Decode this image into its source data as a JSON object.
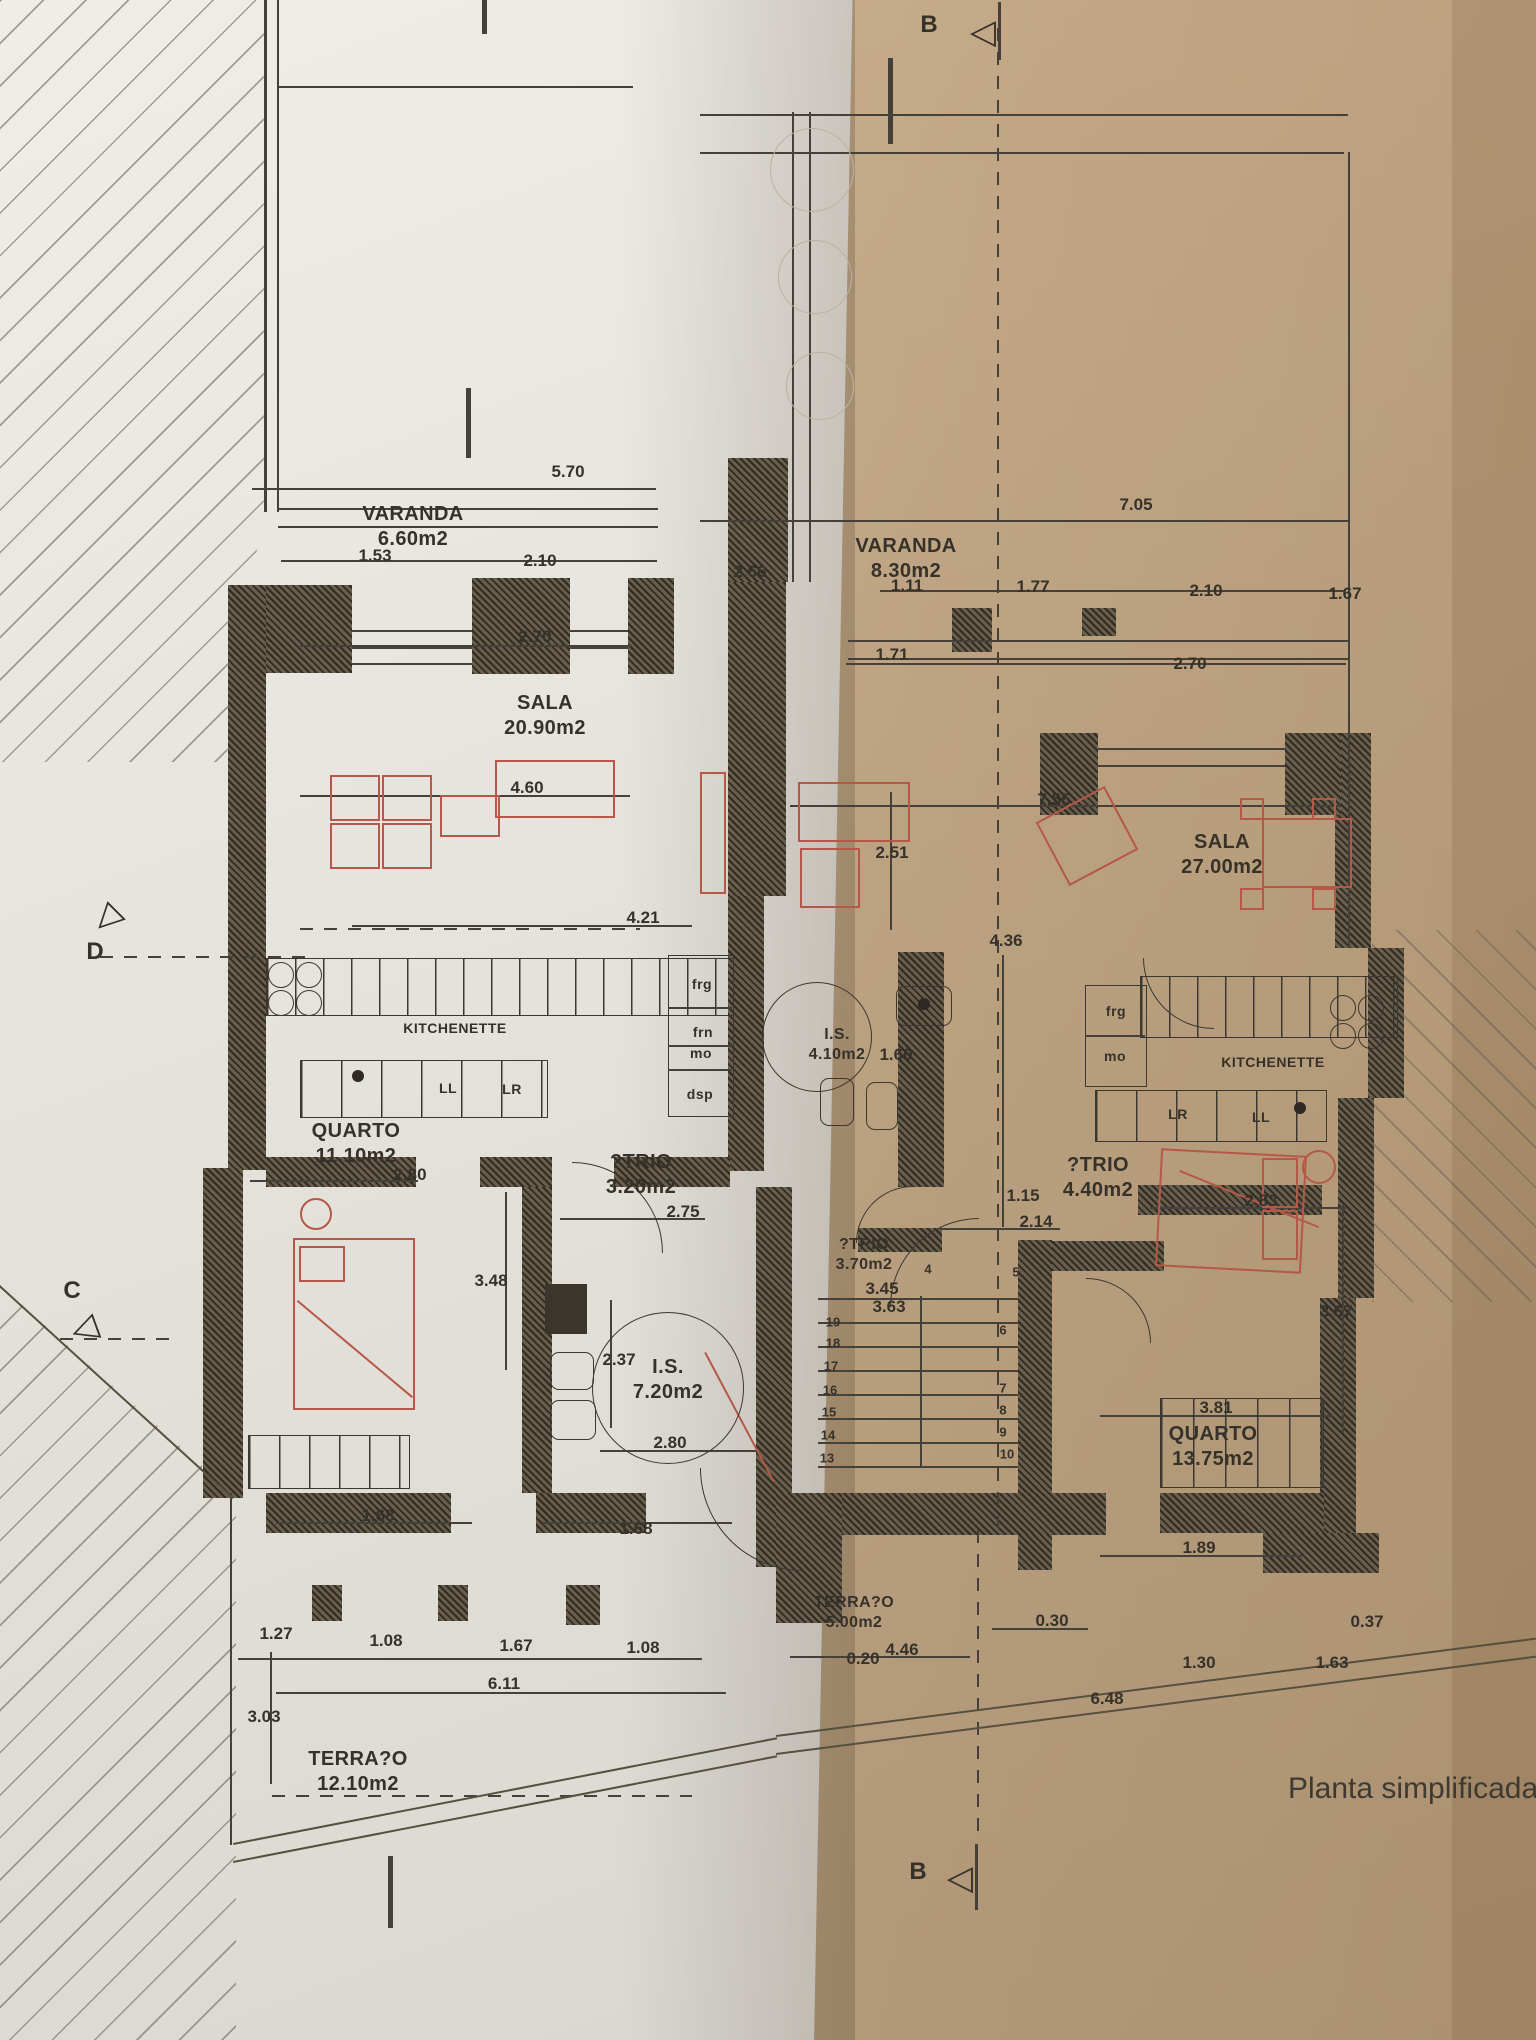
{
  "caption": {
    "text": "Planta simplificada d",
    "x": 1288,
    "y": 1772
  },
  "section_markers": [
    {
      "id": "b-top",
      "letter": "B",
      "x": 929,
      "y": 25,
      "icon": "section-flag",
      "icon_x": 983,
      "icon_y": 32,
      "icon_rot": 0
    },
    {
      "id": "b-bottom",
      "letter": "B",
      "x": 918,
      "y": 1872,
      "icon": "section-flag",
      "icon_x": 960,
      "icon_y": 1878,
      "icon_rot": 0
    },
    {
      "id": "d-left",
      "letter": "D",
      "x": 95,
      "y": 952,
      "icon": "section-flag",
      "icon_x": 106,
      "icon_y": 918,
      "icon_rot": -45
    },
    {
      "id": "c-left",
      "letter": "C",
      "x": 72,
      "y": 1291,
      "icon": "section-flag",
      "icon_x": 84,
      "icon_y": 1328,
      "icon_rot": -20
    }
  ],
  "rooms": [
    {
      "name": "VARANDA",
      "area": "6.60m2",
      "x": 413,
      "y": 527
    },
    {
      "name": "VARANDA",
      "area": "8.30m2",
      "x": 906,
      "y": 559
    },
    {
      "name": "SALA",
      "area": "20.90m2",
      "x": 545,
      "y": 716
    },
    {
      "name": "SALA",
      "area": "27.00m2",
      "x": 1222,
      "y": 855
    },
    {
      "name": "QUARTO",
      "area": "11.10m2",
      "x": 356,
      "y": 1144
    },
    {
      "name": "?TRIO",
      "area": "3.20m2",
      "x": 641,
      "y": 1175
    },
    {
      "name": "?TRIO",
      "area": "4.40m2",
      "x": 1098,
      "y": 1178
    },
    {
      "name": "?TRIO",
      "area": "3.70m2",
      "x": 864,
      "y": 1255,
      "size": "small"
    },
    {
      "name": "I.S.",
      "area": "4.10m2",
      "x": 837,
      "y": 1045,
      "size": "small"
    },
    {
      "name": "I.S.",
      "area": "7.20m2",
      "x": 668,
      "y": 1380
    },
    {
      "name": "QUARTO",
      "area": "13.75m2",
      "x": 1213,
      "y": 1447
    },
    {
      "name": "TERRA?O",
      "area": "5.00m2",
      "x": 854,
      "y": 1613,
      "size": "small"
    },
    {
      "name": "TERRA?O",
      "area": "12.10m2",
      "x": 358,
      "y": 1772
    }
  ],
  "dimensions": [
    {
      "v": "5.70",
      "x": 568,
      "y": 472
    },
    {
      "v": "7.05",
      "x": 1136,
      "y": 505
    },
    {
      "v": "1.53",
      "x": 375,
      "y": 556
    },
    {
      "v": "2.10",
      "x": 540,
      "y": 561
    },
    {
      "v": "2.66",
      "x": 750,
      "y": 572
    },
    {
      "v": "1.11",
      "x": 907,
      "y": 586
    },
    {
      "v": "1.77",
      "x": 1033,
      "y": 587
    },
    {
      "v": "2.10",
      "x": 1206,
      "y": 591
    },
    {
      "v": "1.67",
      "x": 1345,
      "y": 594
    },
    {
      "v": "2.70",
      "x": 535,
      "y": 637
    },
    {
      "v": "1.71",
      "x": 892,
      "y": 655
    },
    {
      "v": "2.70",
      "x": 1190,
      "y": 664
    },
    {
      "v": "4.60",
      "x": 527,
      "y": 788
    },
    {
      "v": "7.55",
      "x": 1054,
      "y": 800
    },
    {
      "v": "2.51",
      "x": 892,
      "y": 853
    },
    {
      "v": "4.21",
      "x": 643,
      "y": 918
    },
    {
      "v": "4.36",
      "x": 1006,
      "y": 941
    },
    {
      "v": "1.60",
      "x": 896,
      "y": 1055
    },
    {
      "v": "2.80",
      "x": 410,
      "y": 1175
    },
    {
      "v": "2.75",
      "x": 683,
      "y": 1212
    },
    {
      "v": "1.15",
      "x": 1023,
      "y": 1196
    },
    {
      "v": "2.14",
      "x": 1036,
      "y": 1222
    },
    {
      "v": "2.83",
      "x": 1261,
      "y": 1201
    },
    {
      "v": "3.45",
      "x": 882,
      "y": 1289
    },
    {
      "v": "3.63",
      "x": 889,
      "y": 1307
    },
    {
      "v": "3.48",
      "x": 491,
      "y": 1281
    },
    {
      "v": "2.37",
      "x": 619,
      "y": 1360
    },
    {
      "v": "3.67",
      "x": 1336,
      "y": 1312
    },
    {
      "v": "2.80",
      "x": 670,
      "y": 1443
    },
    {
      "v": "3.81",
      "x": 1216,
      "y": 1408
    },
    {
      "v": "1.89",
      "x": 1199,
      "y": 1548
    },
    {
      "v": "1.68",
      "x": 378,
      "y": 1516
    },
    {
      "v": "1.68",
      "x": 636,
      "y": 1529
    },
    {
      "v": "0.30",
      "x": 1052,
      "y": 1621
    },
    {
      "v": "0.37",
      "x": 1367,
      "y": 1622
    },
    {
      "v": "0.20",
      "x": 863,
      "y": 1659
    },
    {
      "v": "4.46",
      "x": 902,
      "y": 1650
    },
    {
      "v": "1.30",
      "x": 1199,
      "y": 1663
    },
    {
      "v": "1.63",
      "x": 1332,
      "y": 1663
    },
    {
      "v": "1.27",
      "x": 276,
      "y": 1634
    },
    {
      "v": "1.08",
      "x": 386,
      "y": 1641
    },
    {
      "v": "1.67",
      "x": 516,
      "y": 1646
    },
    {
      "v": "1.08",
      "x": 643,
      "y": 1648
    },
    {
      "v": "6.11",
      "x": 504,
      "y": 1684
    },
    {
      "v": "6.48",
      "x": 1107,
      "y": 1699
    },
    {
      "v": "3.03",
      "x": 264,
      "y": 1717
    }
  ],
  "appliance_labels": [
    {
      "t": "frg",
      "x": 702,
      "y": 984
    },
    {
      "t": "frn",
      "x": 703,
      "y": 1032
    },
    {
      "t": "mo",
      "x": 701,
      "y": 1053
    },
    {
      "t": "dsp",
      "x": 700,
      "y": 1094
    },
    {
      "t": "KITCHENETTE",
      "x": 455,
      "y": 1028
    },
    {
      "t": "LL",
      "x": 448,
      "y": 1088
    },
    {
      "t": "LR",
      "x": 512,
      "y": 1089
    },
    {
      "t": "frg",
      "x": 1116,
      "y": 1011
    },
    {
      "t": "mo",
      "x": 1115,
      "y": 1056
    },
    {
      "t": "KITCHENETTE",
      "x": 1273,
      "y": 1062
    },
    {
      "t": "LR",
      "x": 1178,
      "y": 1114
    },
    {
      "t": "LL",
      "x": 1261,
      "y": 1117
    }
  ],
  "stair_numbers": [
    {
      "t": "19",
      "x": 833,
      "y": 1322
    },
    {
      "t": "18",
      "x": 833,
      "y": 1343
    },
    {
      "t": "17",
      "x": 831,
      "y": 1366
    },
    {
      "t": "16",
      "x": 830,
      "y": 1390
    },
    {
      "t": "15",
      "x": 829,
      "y": 1412
    },
    {
      "t": "14",
      "x": 828,
      "y": 1435
    },
    {
      "t": "13",
      "x": 827,
      "y": 1458
    },
    {
      "t": "4",
      "x": 928,
      "y": 1269
    },
    {
      "t": "5",
      "x": 1016,
      "y": 1272
    },
    {
      "t": "6",
      "x": 1003,
      "y": 1330
    },
    {
      "t": "7",
      "x": 1003,
      "y": 1388
    },
    {
      "t": "8",
      "x": 1003,
      "y": 1410
    },
    {
      "t": "9",
      "x": 1003,
      "y": 1432
    },
    {
      "t": "10",
      "x": 1007,
      "y": 1454
    }
  ],
  "colors": {
    "paper_left": "#e8e5e0",
    "paper_right": "#d7c0a1",
    "ink": "#3a352d",
    "wall": "#554e3f",
    "furniture": "#b55847"
  }
}
